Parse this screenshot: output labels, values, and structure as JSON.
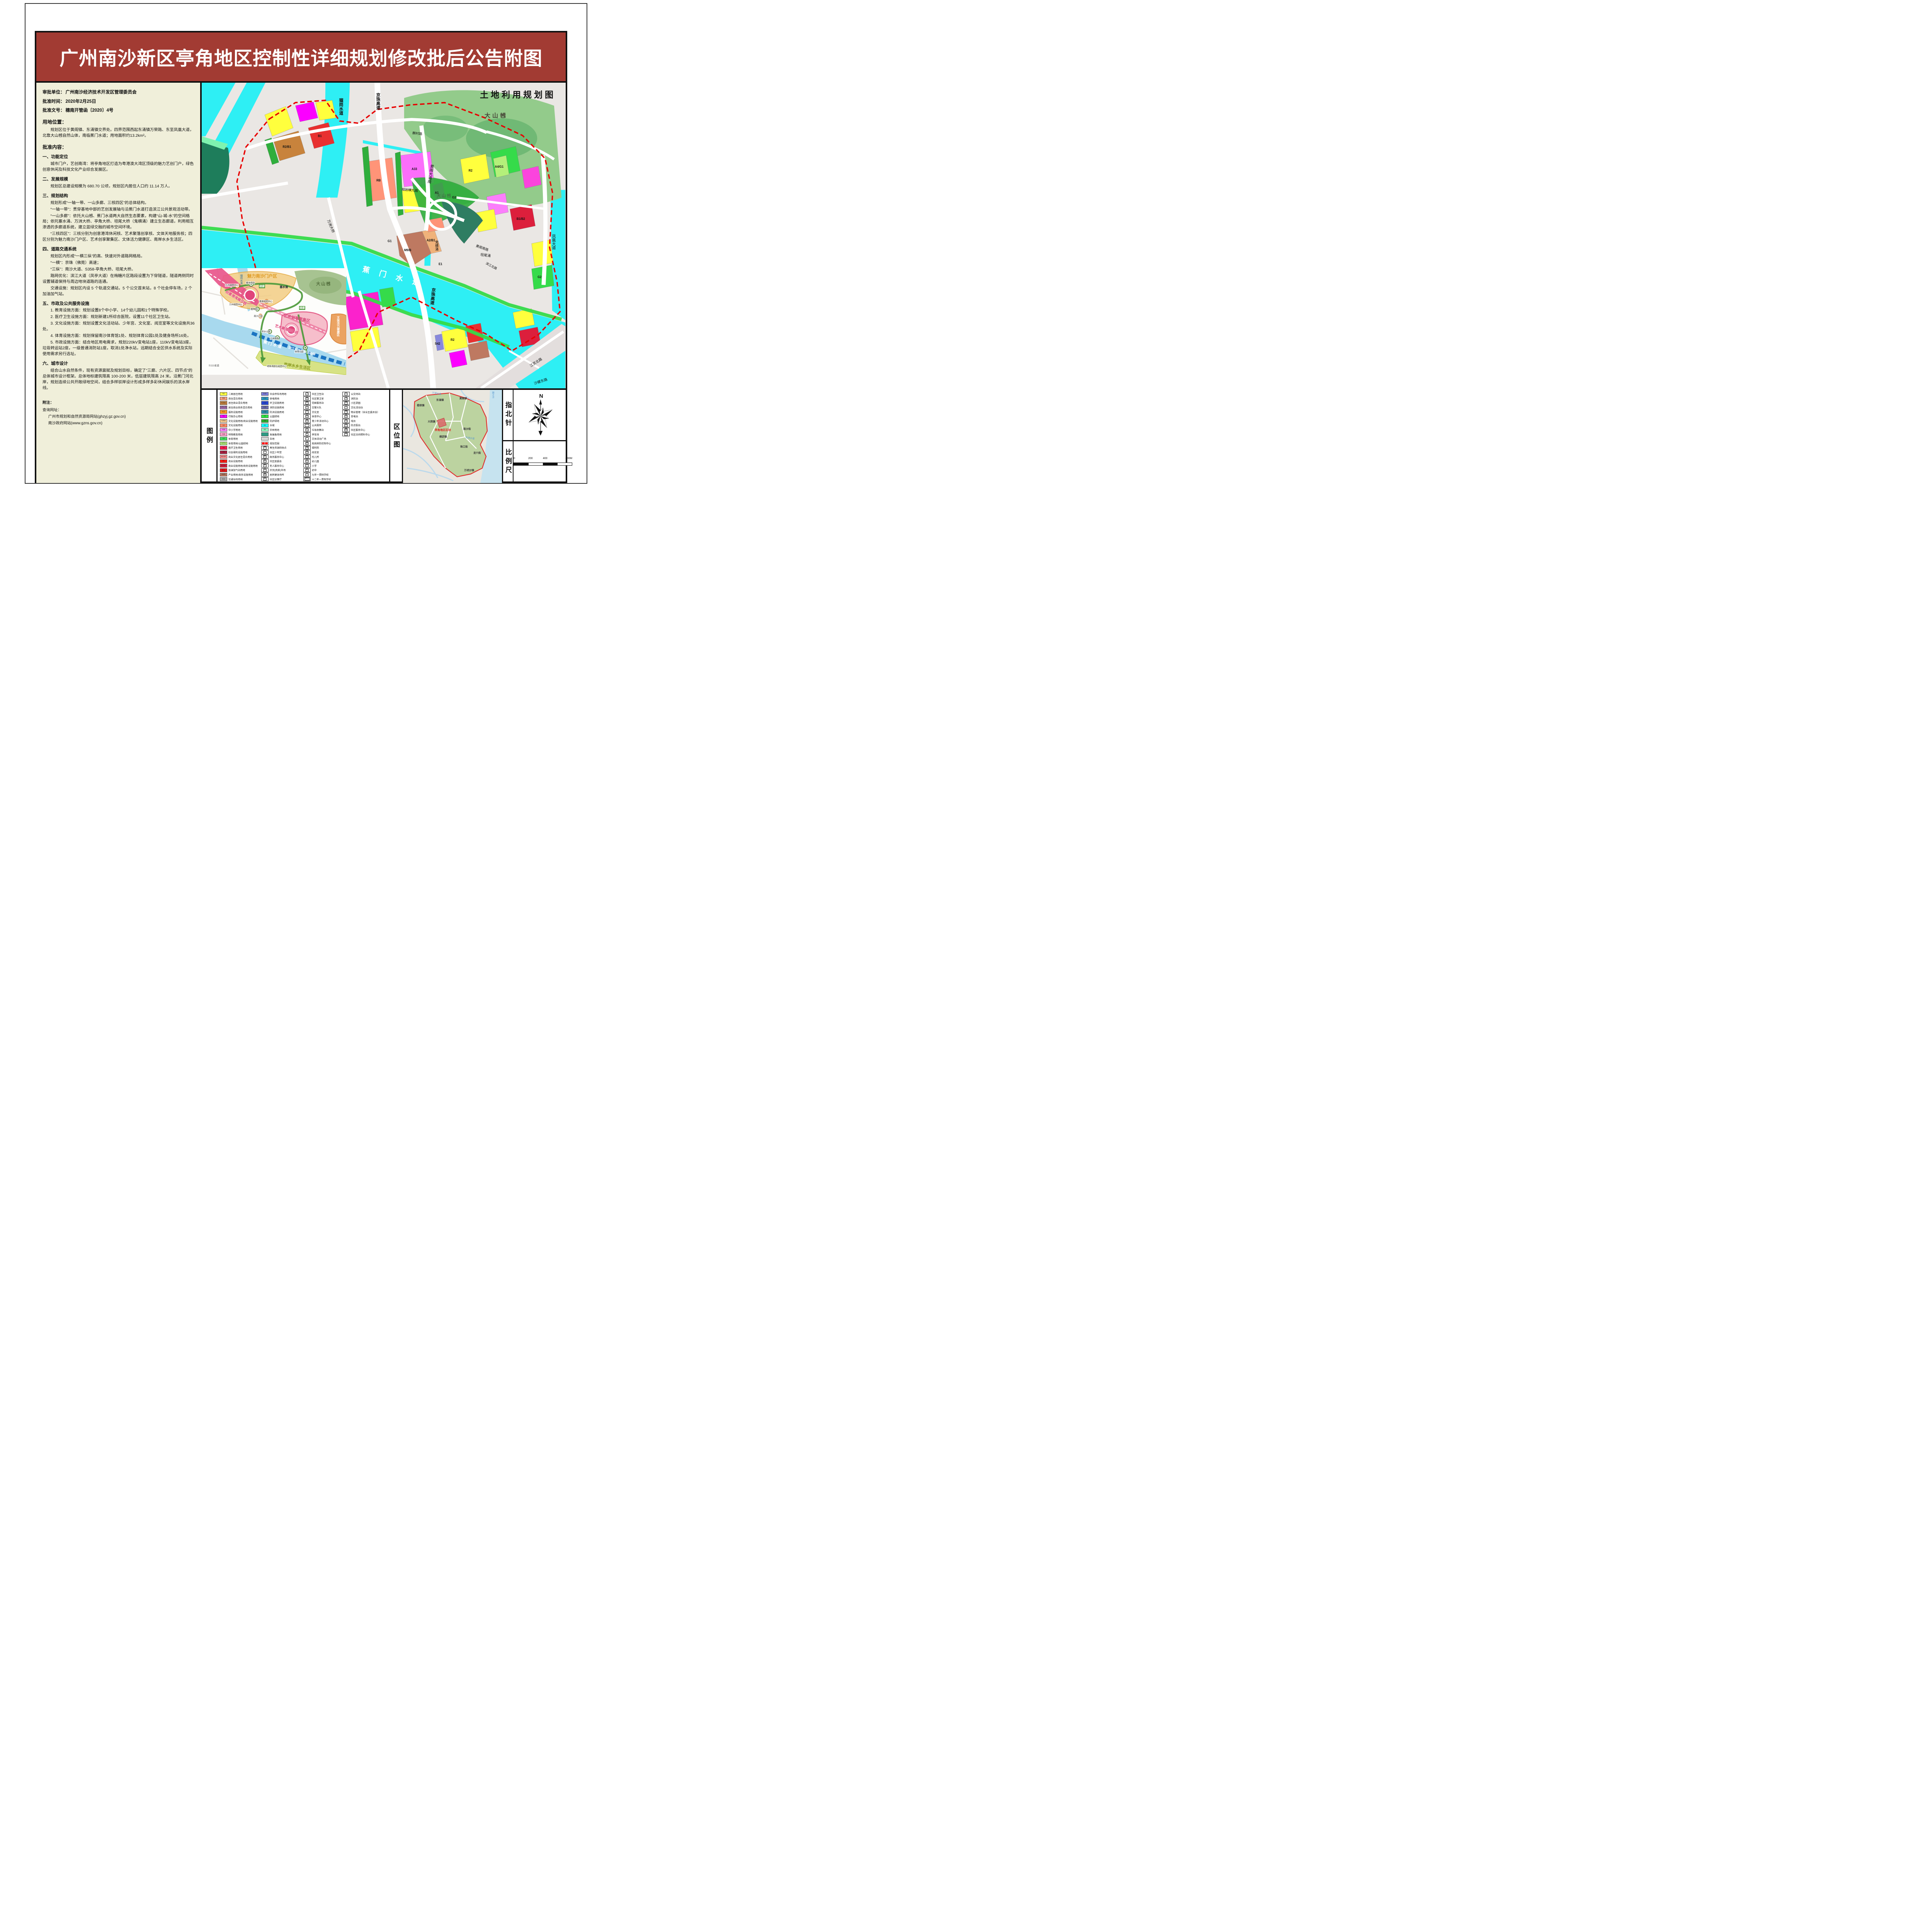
{
  "header": {
    "title": "广州南沙新区亭角地区控制性详细规划修改批后公告附图"
  },
  "info_panel": {
    "header_lines": [
      {
        "label": "审批单位：",
        "value": "广州南沙经济技术开发区管理委员会"
      },
      {
        "label": "批准时间：",
        "value": "2020年2月25日"
      },
      {
        "label": "批准文号：",
        "value": "穗南开管函〔2020〕4号"
      }
    ],
    "location_heading": "用地位置：",
    "location_text": "规划区位于黄阁镇、东涌镇交界处。四界范围西起东涌镇万荣路、东至凤凰大道，北靠大山乸自然山体，南临蕉门水道；用地面积约13.2km²。",
    "content_heading": "批准内容：",
    "sections": [
      {
        "title": "一、功能定位",
        "paragraphs": [
          "城市门户，艺创南湾：将亭角地区打造为粤港澳大湾区顶级的魅力艺创门户，绿色创意休闲及科技文化产业综合发展区。"
        ]
      },
      {
        "title": "二、发展规模",
        "paragraphs": [
          "规划区总建设规模为 680.70 公顷，规划区内居住人口约 11.14 万人。"
        ]
      },
      {
        "title": "三、规划结构",
        "paragraphs": [
          "规划形成“一轴一带、一山多廊、三核四区”的总体结构。",
          "“一轴一带”：贯穿基地中部的艺创发展轴与沿蕉门水道打造滨江公共景观活动带。",
          "“一山多廊”：依托大山乸、蕉门水道两大自然生态要素，构建“山-城-水”的空间格局；依托塞水涌、万洲大桥、亭角大桥、坦尾大桥（鬼横涌）建立生态廊道，利用相互渗透的多廊道系统，建立蓝绿交融的城市空间环境。",
          "“三核四区”：三核分别为创意港湾休闲核、艺术聚落创享核、文体天地服务核；四区分别为魅力南沙门户区、艺术创享聚集区、文体活力健康区、南岸水乡生活区。"
        ]
      },
      {
        "title": "四、道路交通系统",
        "paragraphs": [
          "规划区内形成“一横三纵”的高、快速对外道路网格局。",
          "“一横”：京珠（佛莞）高速；",
          "“三纵”：南沙大道、S358-亭角大桥、坦尾大桥。",
          "路网优化：滨江大道（凤亭大道）在梅糖片区路段设置为下穿隧道，隧道两侧同时设置辅道保持与周边地块道路的连通。",
          "交通设施：规划区内设 5 个轨道交通站，5 个公交首末站，8 个社会停车场，2 个加油加气站。"
        ]
      },
      {
        "title": "五、市政及公共服务设施",
        "paragraphs": [
          "1. 教育设施方面：规划设置8个中小学、14个幼儿园和1个特殊学校。",
          "2. 医疗卫生设施方面：规划新建1所综合医院，设置11个社区卫生站。",
          "3. 文化设施方面：规划设置文化活动站、少年宫、文化室、阅览室等文化设施共36处。",
          "4. 体育设施方面：规划保留南沙体育馆1处、规划体育公园1处及健身场所16处。",
          "5. 市政设施方面：结合地区用电需求，规划220kV变电站1座，110kV变电站3座，垃圾转运站2座，一级普通消防站1座，取消1处净水站，远期结合全区供水系统及实际使用需求另行选址。"
        ]
      },
      {
        "title": "六、城市设计",
        "paragraphs": [
          "结合山水自然条件，现有资源禀赋及规划目标，确定了”三廊、六片区、四节点”的总体城市设计框架。总体地标建筑限高 100-200 米，低层建筑限高 24 米。沿蕉门河北岸，规划连续公共开敞绿地空间，结合多样驳岸设计形成多样多彩休闲娱乐的滨水岸线。"
        ]
      }
    ],
    "notes_heading": "附注：",
    "notes": [
      "查询网址：",
      "广州市规划和自然资源局网站(ghzyj.gz.gov.cn)",
      "南沙政府网站(www.gzns.gov.cn)"
    ]
  },
  "map": {
    "title": "土地利用规划图",
    "labels": {
      "hill_top": "大山乸",
      "hill_mid": "大山乸",
      "river_main": "蕉 门 水 道",
      "river_liugang": "骝岗水道",
      "expressway": "京珠高速",
      "bridge_wanzhou": "万洲大桥",
      "road_huangge_dadao": "黄阁大道南",
      "road_huangge_nanlu": "黄阁南路",
      "road_qicun": "麒村路",
      "road_hengjiu": "规划横九路",
      "road_binjiang": "滨江北路",
      "creek_gui": "鬼横涌",
      "creek_tanwei": "坦尾涌",
      "road_fenghuang": "凤凰大道",
      "road_jiangling": "江灵北路",
      "road_shaluo": "沙螺东路"
    },
    "parcel_codes": [
      "R2",
      "RB",
      "A33",
      "A1",
      "G2",
      "G1",
      "E1",
      "M9/B",
      "A2/B1",
      "B1/B2",
      "S42",
      "R2/B1",
      "B1",
      "A4/G1",
      "R2",
      "G2"
    ],
    "inset": {
      "axis": "艺创发展轴",
      "gateway_zone": "魅力南沙门户区",
      "art_zone": "艺术创享聚集区",
      "culture_zone": "文体活力健康区",
      "south_zone": "南岸水乡生活区",
      "riverside_band": "滨江公共景观活动带",
      "hill": "大山乸",
      "core1": "创意港湾展示核",
      "core2": "艺术聚落创享核",
      "corridor": "绿廊",
      "water_main": "蕉门水道",
      "water_sai": "塞水涌",
      "water_liugang": "骝岗水道",
      "road_s111": "S111省道",
      "nodes": [
        "万州组团中心",
        "都市农田",
        "黄阁组团中心",
        "植物园",
        "南沙之窗",
        "滨水公园",
        "江岸剧场",
        "体育公园",
        "明珠湾居住组团中心"
      ]
    }
  },
  "legend": {
    "panel_label": "图例",
    "columns": [
      {
        "items": [
          {
            "type": "swatch",
            "code": "R2",
            "color": "#FFFF40",
            "label": "二类居住用地"
          },
          {
            "type": "swatch",
            "code": "RB",
            "color": "#FFA080",
            "label": "商住混合用地"
          },
          {
            "type": "swatch",
            "code": "R2/B1",
            "color": "#C8833C",
            "label": "居住商业混合用地"
          },
          {
            "type": "swatch",
            "code": "R2/B1/B2",
            "color": "#AB6EB5",
            "label": "居住商业商务混合用地"
          },
          {
            "type": "swatch",
            "code": "R22",
            "color": "#FF9A1F",
            "label": "服务设施用地"
          },
          {
            "type": "swatch",
            "code": "A1",
            "color": "#FB00FF",
            "label": "行政办公用地"
          },
          {
            "type": "swatch",
            "code": "A2/B1",
            "color": "#FFCE8F",
            "label": "文化设施用地/商业设施用地"
          },
          {
            "type": "swatch",
            "code": "A2",
            "color": "#FF8A65",
            "label": "文化设施用地"
          },
          {
            "type": "swatch",
            "code": "A33",
            "color": "#FB7EFB",
            "label": "中小学用地"
          },
          {
            "type": "swatch",
            "code": "A34",
            "color": "#FF9ECB",
            "label": "特殊教育用地"
          },
          {
            "type": "swatch",
            "code": "A4",
            "color": "#3BDC5C",
            "label": "体育用地"
          },
          {
            "type": "swatch",
            "code": "A4/G1",
            "color": "#B4F07A",
            "label": "体育用地/公园绿地"
          },
          {
            "type": "swatch",
            "code": "A5",
            "color": "#F5154C",
            "label": "医疗卫生用地"
          },
          {
            "type": "swatch",
            "code": "A6",
            "color": "#A81E3E",
            "label": "社会福利设施用地"
          },
          {
            "type": "swatch",
            "code": "B/A/R",
            "color": "#FF8F8F",
            "label": "商业文化居住混合用地"
          },
          {
            "type": "swatch",
            "code": "B1",
            "color": "#FE1B10",
            "label": "商业设施用地"
          },
          {
            "type": "swatch",
            "code": "B1/B2",
            "color": "#DC1F3C",
            "label": "商业设施用地/商务设施用地"
          },
          {
            "type": "swatch",
            "code": "B41",
            "color": "#E81417",
            "label": "加油加气站用地"
          },
          {
            "type": "swatch",
            "code": "M9/B",
            "color": "#BE7961",
            "label": "产业用地/商务设施用地"
          },
          {
            "type": "swatch",
            "code": "S41",
            "color": "#ABABAB",
            "label": "交通站场用地"
          }
        ]
      },
      {
        "items": [
          {
            "type": "swatch",
            "code": "S42",
            "color": "#7E7EDC",
            "label": "社会停车场用地"
          },
          {
            "type": "swatch",
            "code": "U12",
            "color": "#2B9BC4",
            "label": "供电用地"
          },
          {
            "type": "swatch",
            "code": "U22",
            "color": "#2847D8",
            "label": "环卫设施用地"
          },
          {
            "type": "swatch",
            "code": "U31",
            "color": "#6B6BAF",
            "label": "消防设施用地"
          },
          {
            "type": "swatch",
            "code": "U32",
            "color": "#2E8FAE",
            "label": "防洪设施用地"
          },
          {
            "type": "swatch",
            "code": "G1",
            "color": "#2EE943",
            "label": "公园绿地"
          },
          {
            "type": "swatch",
            "code": "G2",
            "color": "#2DAE2D",
            "label": "防护绿地"
          },
          {
            "type": "swatch",
            "code": "E1",
            "color": "#19FFFF",
            "label": "水域"
          },
          {
            "type": "swatch",
            "code": "E2",
            "color": "#8FF8C0",
            "label": "农林用地"
          },
          {
            "type": "swatch",
            "code": "",
            "color": "#2E9B84",
            "label": "发展备用地"
          },
          {
            "type": "swatch",
            "code": "",
            "color": "#D9D9D9",
            "label": "白地"
          },
          {
            "type": "boundary",
            "label": "规划范围"
          },
          {
            "type": "icon",
            "glyph": "再",
            "label": "再生资源回收点"
          },
          {
            "type": "icon",
            "glyph": "少",
            "label": "社区少年宫"
          },
          {
            "type": "icon",
            "glyph": "政",
            "label": "政务服务中心"
          },
          {
            "type": "icon",
            "glyph": "居",
            "label": "社区居委会"
          },
          {
            "type": "icon",
            "glyph": "老",
            "label": "老人服务中心"
          },
          {
            "type": "icon",
            "glyph": "菜",
            "label": "农贸(肉菜)市场"
          },
          {
            "type": "icon",
            "glyph": "健",
            "label": "居民健身场所"
          },
          {
            "type": "icon",
            "glyph": "议",
            "label": "社区议事厅"
          }
        ]
      },
      {
        "items": [
          {
            "type": "icon",
            "glyph": "卫",
            "label": "社区卫生站"
          },
          {
            "type": "icon",
            "glyph": "警",
            "label": "社区警卫室"
          },
          {
            "type": "icon",
            "glyph": "党",
            "label": "党群服务站"
          },
          {
            "type": "icon",
            "glyph": "交",
            "label": "交警大队"
          },
          {
            "type": "icon",
            "glyph": "文",
            "label": "文化室"
          },
          {
            "type": "icon",
            "glyph": "体",
            "label": "体育中心"
          },
          {
            "type": "icon",
            "glyph": "青",
            "label": "青少年活动中心"
          },
          {
            "type": "icon",
            "glyph": "♀♂",
            "label": "公共厕所"
          },
          {
            "type": "icon",
            "glyph": "垃",
            "label": "垃圾收集站"
          },
          {
            "type": "icon",
            "glyph": "P",
            "label": "停车场"
          },
          {
            "type": "icon",
            "glyph": "广",
            "label": "文体活动广场"
          },
          {
            "type": "icon",
            "glyph": "疾",
            "label": "疾病预防控制中心"
          },
          {
            "type": "icon",
            "glyph": "福",
            "label": "福利院"
          },
          {
            "type": "icon",
            "glyph": "阅",
            "label": "阅览室"
          },
          {
            "type": "icon",
            "glyph": "托",
            "label": "托儿所"
          },
          {
            "type": "icon",
            "glyph": "幼",
            "label": "幼儿园"
          },
          {
            "type": "icon",
            "glyph": "小",
            "label": "小学"
          },
          {
            "type": "icon",
            "glyph": "初",
            "label": "初中"
          },
          {
            "type": "icon",
            "glyph": "九",
            "label": "九年一贯制学校"
          },
          {
            "type": "icon",
            "glyph": "十二",
            "label": "十二年一贯制学校"
          }
        ]
      },
      {
        "items": [
          {
            "type": "icon",
            "glyph": "车",
            "label": "公交场站"
          },
          {
            "type": "icon",
            "glyph": "消",
            "label": "消防站"
          },
          {
            "type": "icon",
            "glyph": "游",
            "label": "小区游园"
          },
          {
            "type": "icon",
            "glyph": "文",
            "label": "文化活动站"
          },
          {
            "type": "icon",
            "glyph": "物",
            "label": "物业管理（含业主委员会）"
          },
          {
            "type": "icon",
            "glyph": "变",
            "label": "变电站"
          },
          {
            "type": "icon",
            "glyph": "戏",
            "label": "戏台"
          },
          {
            "type": "icon",
            "glyph": "泵",
            "label": "防涝泵站"
          },
          {
            "type": "icon",
            "glyph": "服",
            "label": "社区服务中心"
          },
          {
            "type": "icon",
            "glyph": "照",
            "label": "社区日间照料中心"
          }
        ]
      }
    ]
  },
  "region_map": {
    "panel_label": "区位图",
    "towns": [
      "东涌镇",
      "榄核镇",
      "大岗镇",
      "黄阁镇",
      "南沙街",
      "横沥镇",
      "珠江街",
      "龙穴街",
      "万顷沙镇"
    ],
    "waters": [
      "沙湾水道",
      "凫洲水道",
      "狮子洋"
    ],
    "highlight": "亭角地区区块"
  },
  "compass": {
    "panel_label": "指北针",
    "north_label": "N"
  },
  "scalebar": {
    "panel_label": "比例尺",
    "ticks": [
      "0",
      "200",
      "400",
      "800M"
    ]
  }
}
